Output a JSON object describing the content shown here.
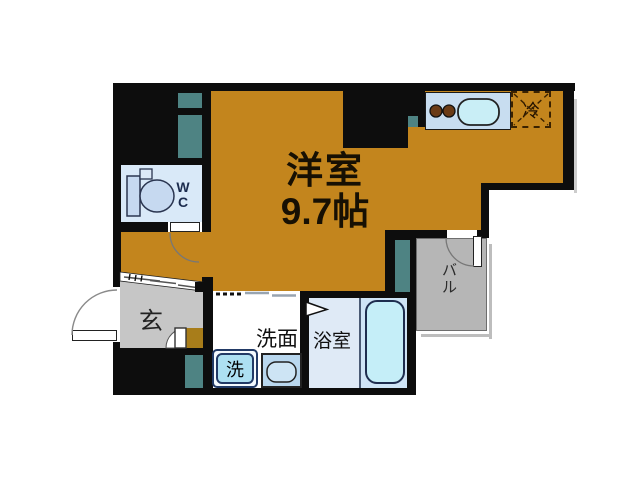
{
  "plan": {
    "type": "apartment-floor-plan",
    "rooms": {
      "main": {
        "label": "洋室",
        "size": "9.7帖"
      },
      "wc": {
        "label": "WC"
      },
      "entrance": {
        "label": "玄"
      },
      "vanity": {
        "label": "洗面"
      },
      "washer": {
        "label": "洗"
      },
      "bath": {
        "label": "浴室"
      },
      "balcony": {
        "label": "バル"
      },
      "fridge": {
        "label": "冷"
      }
    },
    "colors": {
      "floor_orange": "#c3851d",
      "wall_black": "#0d0d0d",
      "duct_teal": "#4e8383",
      "tile_blue": "#d9e9f8",
      "counter_blue": "#c8ddf0",
      "bathtub_cyan": "#c5eef8",
      "entrance_gray": "#c6c6c6",
      "balcony_gray": "#b6b6b6",
      "step_brown": "#a87d1a"
    }
  }
}
